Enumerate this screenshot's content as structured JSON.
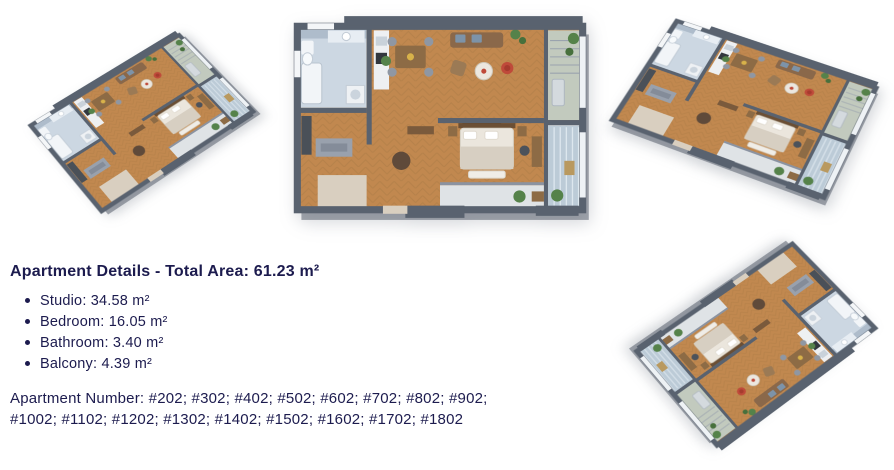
{
  "details": {
    "heading": "Apartment Details - Total Area: 61.23 m²",
    "bullets": [
      "Studio: 34.58 m²",
      "Bedroom: 16.05 m²",
      "Bathroom: 3.40 m²",
      "Balcony: 4.39 m²"
    ],
    "apartment_numbers_line1": "Apartment Number: #202; #302; #402; #502; #602; #702; #802; #902;",
    "apartment_numbers_line2": "#1002; #1102; #1202; #1302; #1402; #1502; #1602; #1702; #1802"
  },
  "floorplans": {
    "views": [
      {
        "id": "floorplan-isometric-left",
        "type": "isometric-3d-render"
      },
      {
        "id": "floorplan-top-down-center",
        "type": "top-down-render"
      },
      {
        "id": "floorplan-isometric-right",
        "type": "isometric-3d-render"
      },
      {
        "id": "floorplan-isometric-bottom",
        "type": "isometric-3d-render"
      }
    ]
  },
  "colors": {
    "background": "#ffffff",
    "text_navy": "#1c1b4e",
    "wall_gray": "#59626f",
    "floor_wood": "#c1884f",
    "bathroom_tile": "#ccd7e2",
    "accent_red": "#bf4a3a",
    "plant_green": "#55824a"
  }
}
